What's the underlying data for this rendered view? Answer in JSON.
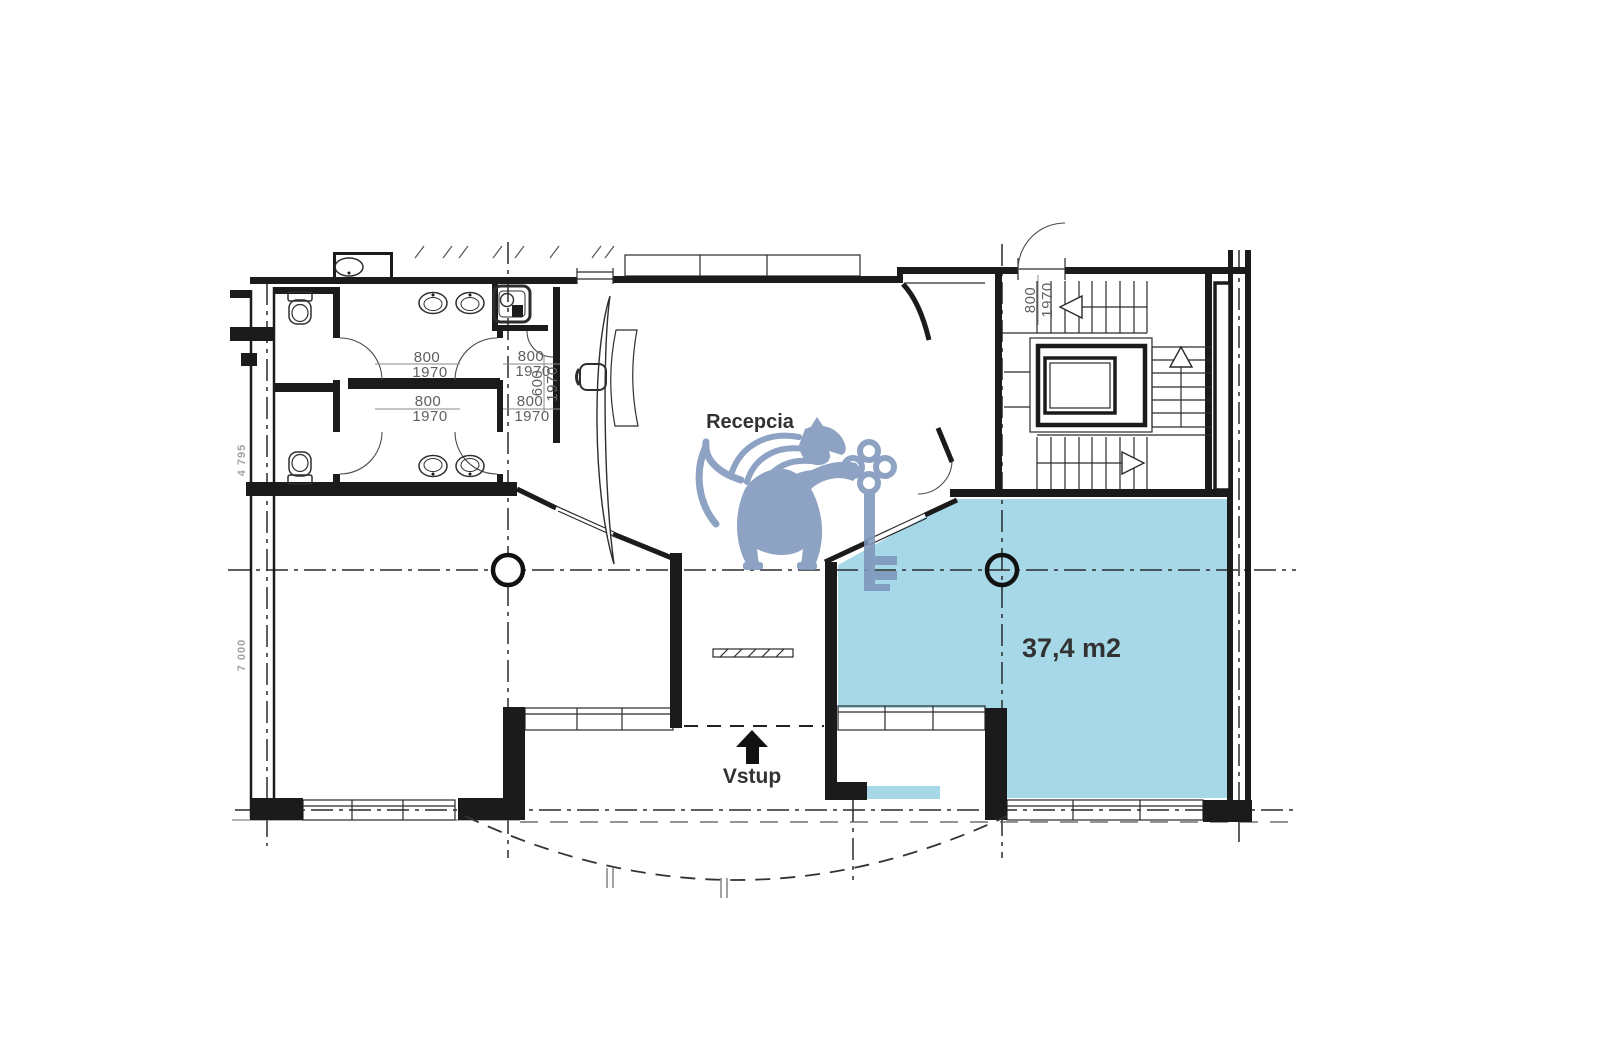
{
  "labels": {
    "reception": "Recepcia",
    "entrance": "Vstup",
    "highlighted_area": "37,4 m2"
  },
  "dimensions": {
    "wc_door_top_left": {
      "width": "800",
      "height": "1970"
    },
    "wc_door_top_right": {
      "width": "800",
      "height": "1970"
    },
    "wc_door_bottom_left": {
      "width": "800",
      "height": "1970"
    },
    "wc_door_bottom_right": {
      "width": "800",
      "height": "1970"
    },
    "closet_door": {
      "width": "600",
      "height": "1970"
    },
    "staircase_door": {
      "width": "800",
      "height": "1970"
    },
    "facade_left_upper": "4 795",
    "facade_left_lower": "7 000"
  },
  "colors": {
    "highlight_fill": "#a6d8e7",
    "watermark": "#7e95bb",
    "ink": "#1b1b1b",
    "dimension_text": "#5f5f5f",
    "label_text": "#323232",
    "area_text": "#243140",
    "background": "#ffffff"
  },
  "icons": [
    "entrance-arrow-icon",
    "lion-key-watermark",
    "column-symbol",
    "stair-direction-arrow",
    "toilet-icon",
    "sink-icon",
    "mop-sink-icon",
    "reception-desk-icon",
    "elevator-icon"
  ]
}
